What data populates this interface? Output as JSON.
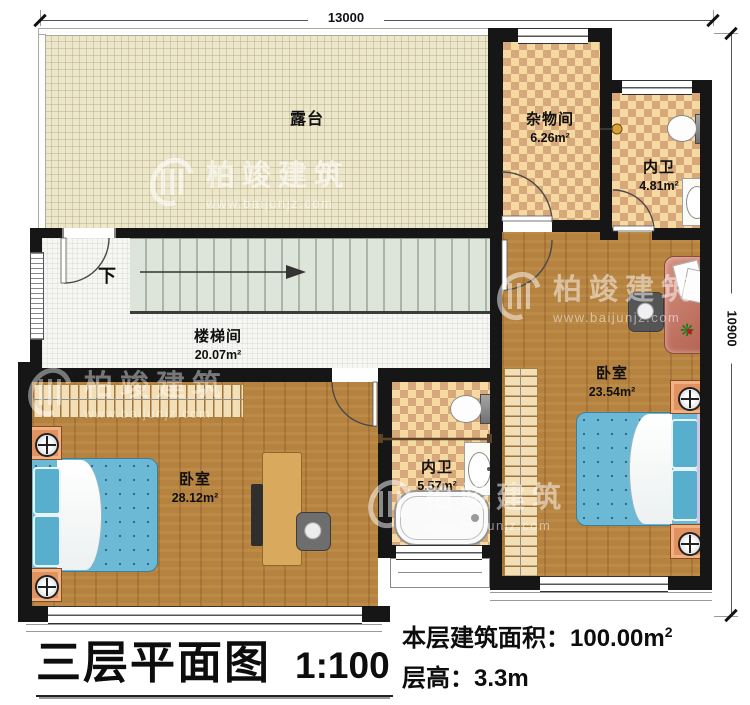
{
  "watermark": {
    "brand": "柏竣建筑",
    "url": "www.baijunjz.com"
  },
  "dimensions": {
    "top": "13000",
    "right": "10900"
  },
  "rooms": {
    "terrace": {
      "name": "露台"
    },
    "storage": {
      "name": "杂物间",
      "area": "6.26m²"
    },
    "bath_top": {
      "name": "内卫",
      "area": "4.81m²"
    },
    "stairwell": {
      "name": "楼梯间",
      "area": "20.07m²"
    },
    "bedroom_left": {
      "name": "卧室",
      "area": "28.12m²"
    },
    "bath_mid": {
      "name": "内卫",
      "area": "5.57m²"
    },
    "bedroom_right": {
      "name": "卧室",
      "area": "23.54m²"
    }
  },
  "stairs": {
    "down_label": "下"
  },
  "titleblock": {
    "plan_name": "三层平面图",
    "scale": "1:100",
    "area_label": "本层建筑面积：",
    "area_value": "100.00m",
    "area_sup": "2",
    "floor_height": "层高：3.3m"
  },
  "colors": {
    "wall": "#161616",
    "tile_light": "#f6d9a1",
    "tile_dark": "#d8a87d",
    "wood": "#b5823f",
    "terrace_floor": "#ece6cb",
    "stair_tread": "#dde4d9",
    "bed_blue": "#6cb9d6",
    "nightstand_orange": "#e2925f",
    "desk_tan": "#d9a95e",
    "table_red": "#c67f69"
  }
}
